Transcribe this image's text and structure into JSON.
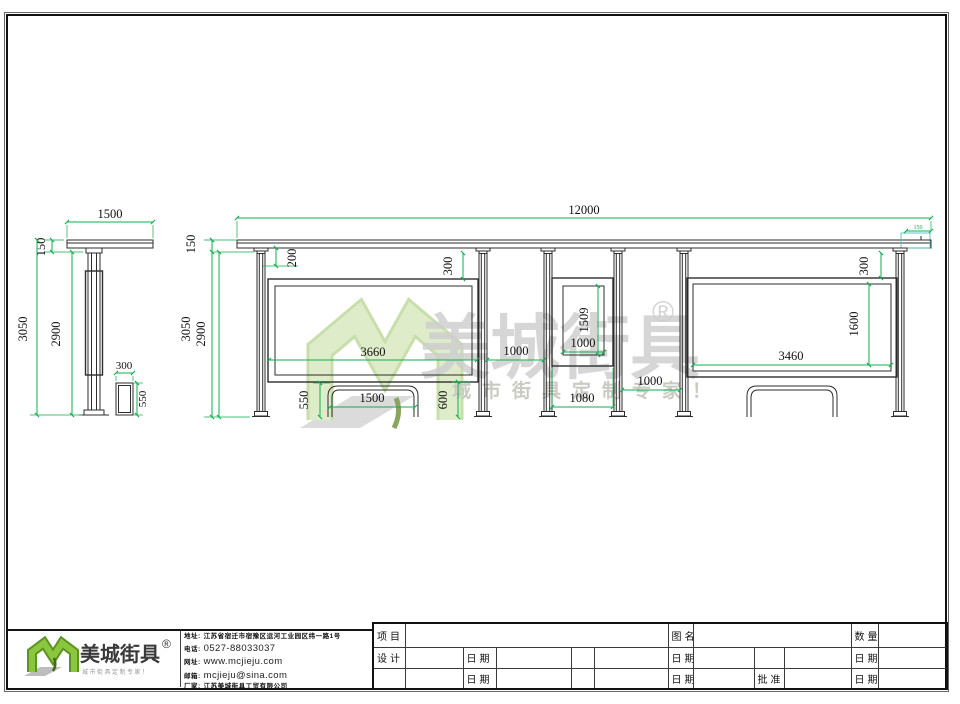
{
  "colors": {
    "dimension_green": "#0fae4f",
    "line_dark": "#2d2d2d",
    "logo_green": "#76b82a",
    "watermark_green": "#d9e8c0",
    "detail_cyan": "#4ec3c9"
  },
  "watermark": {
    "brand": "美城街具",
    "registered": "®",
    "tagline": "城市街具定制专家！"
  },
  "side_view": {
    "top_width": "1500",
    "roof_height": "150",
    "total_height": "3050",
    "column_height": "2900",
    "bin_width": "300",
    "bin_height": "550"
  },
  "front_view": {
    "total_width": "12000",
    "roof_height": "150",
    "total_height": "3050",
    "column_height": "2900",
    "roof_to_rail": "200",
    "roof_to_board_left": "300",
    "left_board_width": "3660",
    "gap_left": "1000",
    "panel_width": "1000",
    "panel_height": "1509",
    "panel_outer_width": "1080",
    "gap_right": "1000",
    "bench_height": "550",
    "bench_width": "1500",
    "clearance": "600",
    "right_board_width": "3460",
    "right_board_height": "1600",
    "roof_to_board_right": "300",
    "roof_edge": "150"
  },
  "footer_logo": {
    "brand": "美城街具",
    "registered": "®",
    "tagline": "城市街具定制专家！"
  },
  "contact": {
    "address_label": "地址:",
    "address": "江苏省宿迁市宿豫区运河工业园区纬一路1号",
    "phone_label": "电话:",
    "phone": "0527-88033037",
    "web_label": "网址:",
    "web": "www.mcjieju.com",
    "email_label": "邮箱:",
    "email": "mcjieju@sina.com",
    "factory_label": "厂家:",
    "factory": "江苏美城街具工贸有限公司"
  },
  "titleblock": {
    "project": "项目",
    "drawing_name": "图名",
    "quantity": "数量",
    "design": "设计",
    "date": "日期",
    "approve": "批准"
  }
}
